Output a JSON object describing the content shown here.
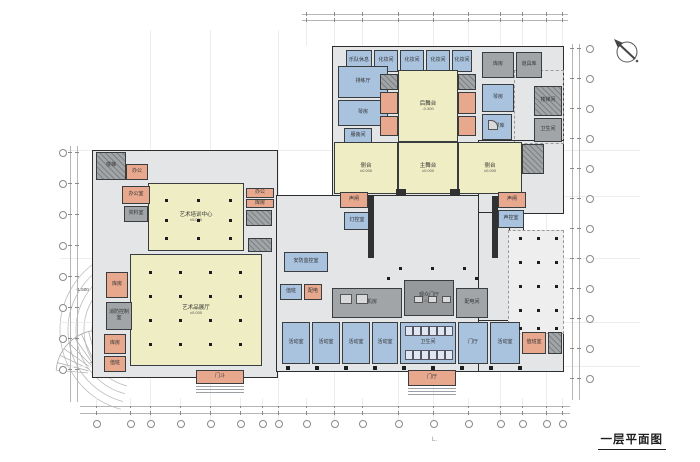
{
  "title": {
    "label": "一层平面图",
    "corner_mark": "L."
  },
  "north_arrow": "north-arrow",
  "colors": {
    "hall_yellow": "#eeedc3",
    "room_blue": "#a9c3de",
    "room_salmon": "#e7a88e",
    "core_gray": "#a2a5a7",
    "floor_gray": "#e4e5e6",
    "wall": "#2b2d2f"
  },
  "seating": {
    "label": "一层观众厅",
    "capacity": "600座"
  },
  "annotations": {
    "site_note": "铺装、绿化见总图",
    "dock_entry": "货运入口",
    "dock_platform": "卸货平台 -1.100",
    "platform_label": "室外平台",
    "platform_elev": "-0.450",
    "lobby_label": "休息厅",
    "lobby_elev": "-0.450",
    "arc_elev": "-1.500",
    "steps_elev": "-0.450"
  },
  "rooms": {
    "rear_stage": {
      "label": "后舞台",
      "elev": "-0.300"
    },
    "main_stage": {
      "label": "主舞台",
      "elev": "±0.000"
    },
    "side_stage_l": {
      "label": "侧台",
      "elev": "±0.000"
    },
    "side_stage_r": {
      "label": "侧台",
      "elev": "±0.000"
    },
    "dress1": {
      "label": "乐队休息"
    },
    "dress2": {
      "label": "化妆间"
    },
    "dress3": {
      "label": "化妆间"
    },
    "dress4": {
      "label": "化妆间"
    },
    "dress5": {
      "label": "化妆间"
    },
    "storage1": {
      "label": "库房"
    },
    "storage2": {
      "label": "道具库"
    },
    "rehearsal": {
      "label": "排练厅"
    },
    "piano1": {
      "label": "琴房"
    },
    "fitting": {
      "label": "服装间"
    },
    "piano2": {
      "label": "琴房"
    },
    "piano_store": {
      "label": "钢琴库"
    },
    "stair_r2": {
      "label": "楼梯间"
    },
    "wc1": {
      "label": "卫生间"
    },
    "soundlock_l": {
      "label": "声闸"
    },
    "soundlock_r": {
      "label": "声闸"
    },
    "light_ctl": {
      "label": "灯控室"
    },
    "sound_ctl": {
      "label": "声控室"
    },
    "ahu": {
      "label": "空调机房"
    },
    "aud_lobby": {
      "label": "观众门厅",
      "elev": "-0.450"
    },
    "transformer": {
      "label": "配电间"
    },
    "duty": {
      "label": "值班"
    },
    "power": {
      "label": "配电"
    },
    "shop1": {
      "label": "活动室"
    },
    "shop2": {
      "label": "活动室"
    },
    "shop3": {
      "label": "活动室"
    },
    "shop4": {
      "label": "活动室"
    },
    "wc2": {
      "label": "卫生间"
    },
    "lobby2": {
      "label": "门厅"
    },
    "shop5": {
      "label": "活动室"
    },
    "duty_room": {
      "label": "值班室"
    },
    "vest1": {
      "label": "门斗"
    },
    "vest2": {
      "label": "门厅"
    },
    "train_hall": {
      "label": "艺术培训中心",
      "elev": "±0.000"
    },
    "exhib_hall": {
      "label": "艺术品展厅",
      "elev": "±0.000"
    },
    "office_a": {
      "label": "办公室"
    },
    "archive": {
      "label": "资料室"
    },
    "stair_l2": {
      "label": "楼梯"
    },
    "office_b": {
      "label": "办公"
    },
    "office_c": {
      "label": "办公"
    },
    "office_d": {
      "label": "库房"
    },
    "store_l3": {
      "label": "库房"
    },
    "fire_ctrl": {
      "label": "消防控制室"
    },
    "store_l4": {
      "label": "库房"
    },
    "store_l5": {
      "label": "值班"
    },
    "security": {
      "label": "安防监控室"
    }
  }
}
